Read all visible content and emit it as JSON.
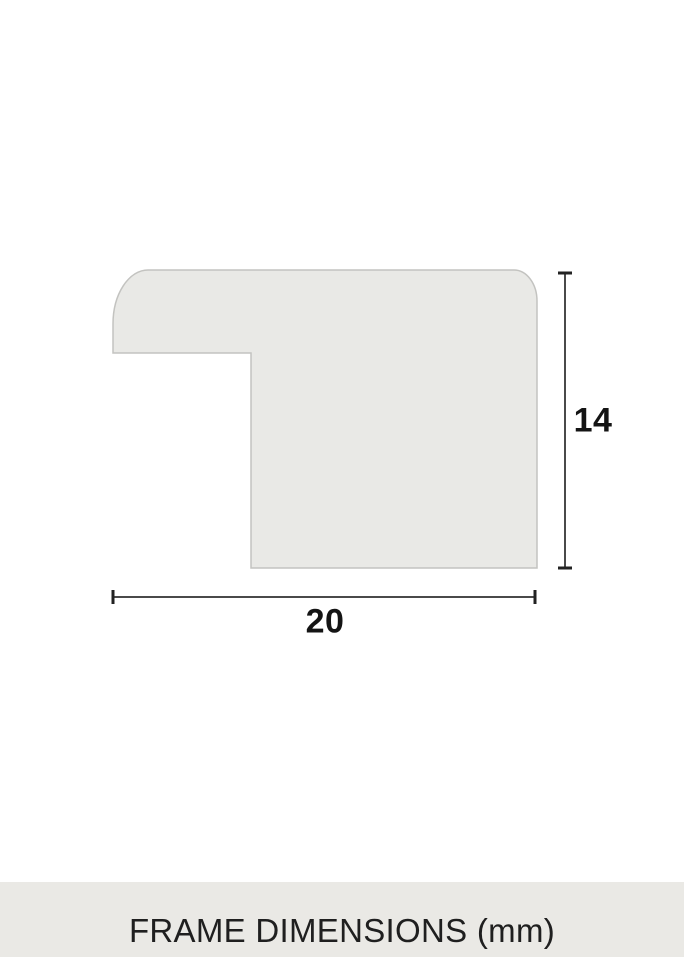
{
  "diagram": {
    "height_dimension": {
      "label": "14",
      "value": 14
    },
    "width_dimension": {
      "label": "20",
      "value": 20
    },
    "unit": "mm"
  },
  "footer": {
    "caption": "FRAME DIMENSIONS (mm)"
  },
  "colors": {
    "background": "#ffffff",
    "shape_fill": "#e9e9e6",
    "shape_outline": "#c3c3c0",
    "dimension_line": "#4a4a4a",
    "dimension_cap": "#222222",
    "label_text": "#141414",
    "footer_background": "#eae9e5",
    "footer_text": "#1f1f1f"
  }
}
